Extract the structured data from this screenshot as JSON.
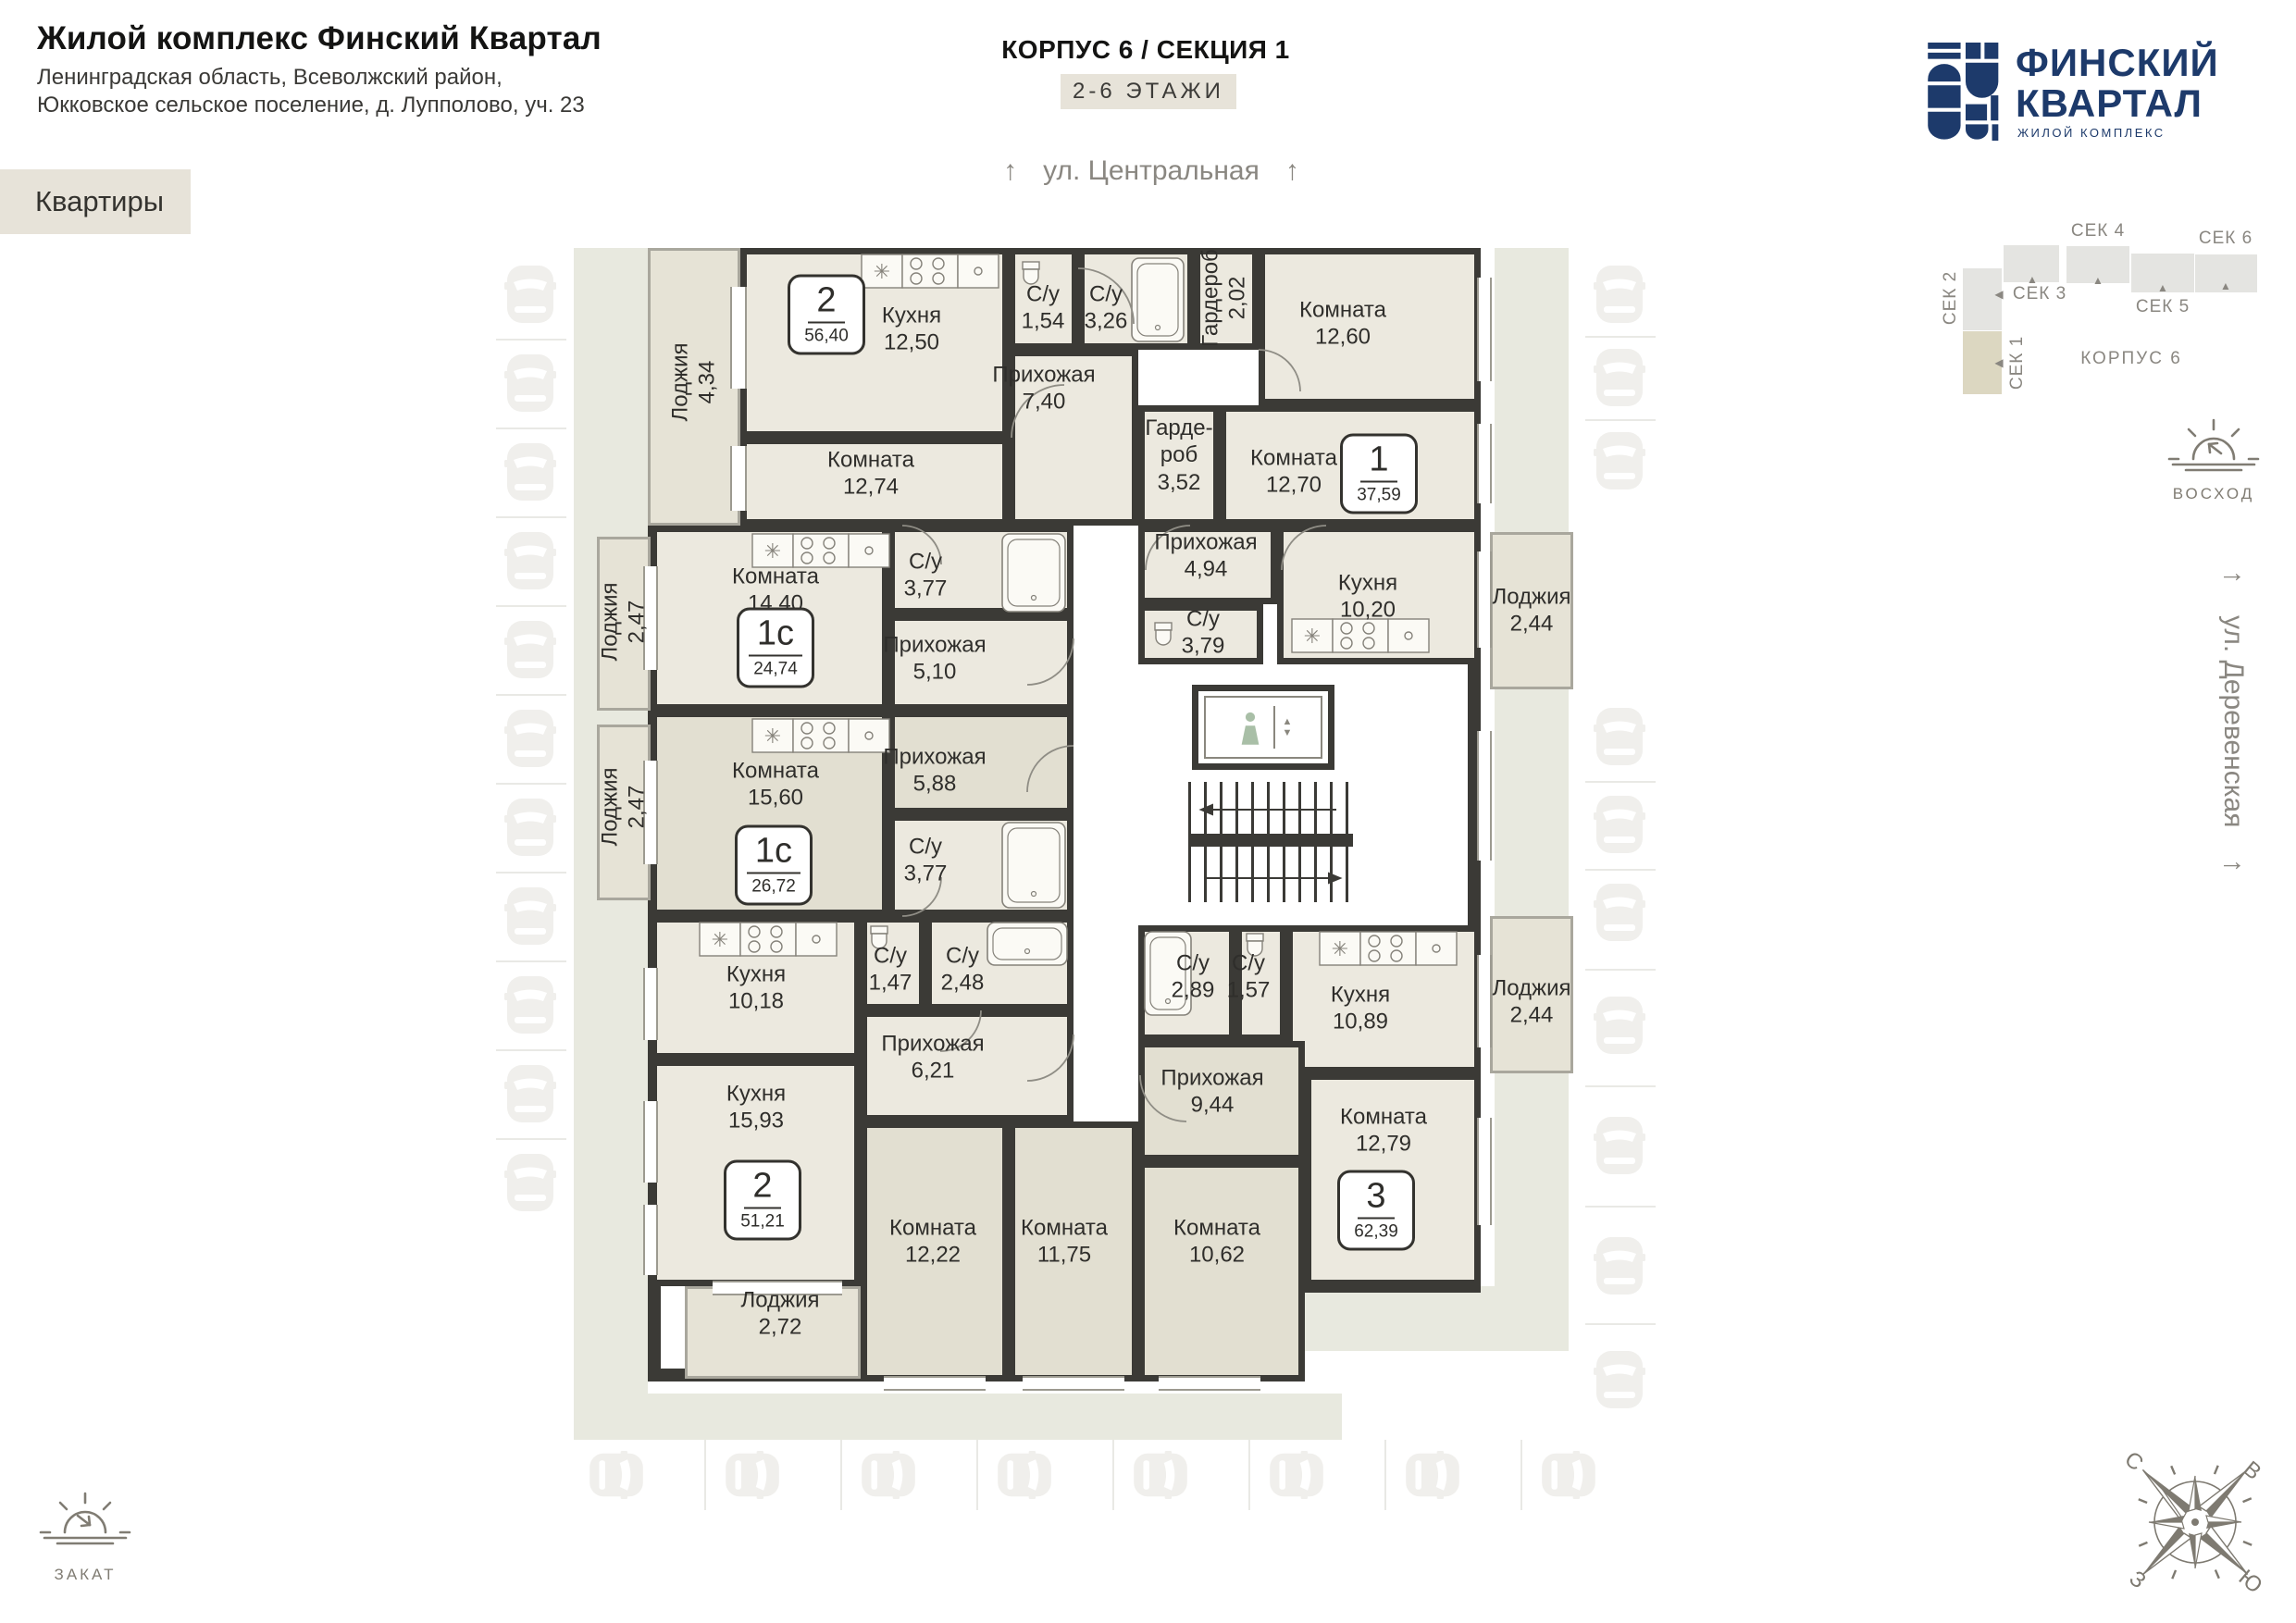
{
  "header": {
    "title": "Жилой комплекс Финский Квартал",
    "subtitle1": "Ленинградская область, Всеволжский район,",
    "subtitle2": "Юкковское сельское поселение, д. Лупполово, уч. 23",
    "tab_label": "Квартиры",
    "corpus_title": "КОРПУС 6 / СЕКЦИЯ 1",
    "floors_label": "2-6 ЭТАЖИ"
  },
  "streets": {
    "top": "ул. Центральная",
    "right": "ул. Деревенская",
    "arrow_up": "↑"
  },
  "logo": {
    "line1": "ФИНСКИЙ",
    "line2": "КВАРТАЛ",
    "subline": "ЖИЛОЙ КОМПЛЕКС"
  },
  "section_map": {
    "corpus_label": "КОРПУС 6",
    "sections": [
      {
        "id": "sek1",
        "label": "СЕК 1",
        "active": true
      },
      {
        "id": "sek2",
        "label": "СЕК 2",
        "active": false
      },
      {
        "id": "sek3",
        "label": "СЕК 3",
        "active": false
      },
      {
        "id": "sek4",
        "label": "СЕК 4",
        "active": false
      },
      {
        "id": "sek5",
        "label": "СЕК 5",
        "active": false
      },
      {
        "id": "sek6",
        "label": "СЕК 6",
        "active": false
      }
    ]
  },
  "sun": {
    "rise": "ВОСХОД",
    "set": "ЗАКАТ"
  },
  "compass": {
    "n": "С",
    "e": "В",
    "s": "Ю",
    "w": "З"
  },
  "plan": {
    "apartments": [
      {
        "id": "a1",
        "num": "2",
        "area": "56,40"
      },
      {
        "id": "a2",
        "num": "1",
        "area": "37,59"
      },
      {
        "id": "a3",
        "num": "1с",
        "area": "24,74"
      },
      {
        "id": "a4",
        "num": "1с",
        "area": "26,72"
      },
      {
        "id": "a5",
        "num": "2",
        "area": "51,21"
      },
      {
        "id": "a6",
        "num": "3",
        "area": "62,39"
      }
    ],
    "rooms": [
      {
        "id": "loggia434",
        "name": "Лоджия",
        "area": "4,34"
      },
      {
        "id": "kit1250",
        "name": "Кухня",
        "area": "12,50"
      },
      {
        "id": "su154",
        "name": "С/у",
        "area": "1,54"
      },
      {
        "id": "su326",
        "name": "С/у",
        "area": "3,26"
      },
      {
        "id": "ward202",
        "name": "Гардероб",
        "area": "2,02"
      },
      {
        "id": "hall740",
        "name": "Прихожая",
        "area": "7,40"
      },
      {
        "id": "room1274",
        "name": "Комната",
        "area": "12,74"
      },
      {
        "id": "room1260",
        "name": "Комната",
        "area": "12,60"
      },
      {
        "id": "ward352",
        "name": "Гарде-\nроб",
        "area": "3,52"
      },
      {
        "id": "room1270",
        "name": "Комната",
        "area": "12,70"
      },
      {
        "id": "hall494",
        "name": "Прихожая",
        "area": "4,94"
      },
      {
        "id": "su379",
        "name": "С/у",
        "area": "3,79"
      },
      {
        "id": "kit1020",
        "name": "Кухня",
        "area": "10,20"
      },
      {
        "id": "loggia244t",
        "name": "Лоджия",
        "area": "2,44"
      },
      {
        "id": "loggia247a",
        "name": "Лоджия",
        "area": "2,47"
      },
      {
        "id": "room1440",
        "name": "Комната",
        "area": "14,40"
      },
      {
        "id": "su377a",
        "name": "С/у",
        "area": "3,77"
      },
      {
        "id": "hall510",
        "name": "Прихожая",
        "area": "5,10"
      },
      {
        "id": "loggia247b",
        "name": "Лоджия",
        "area": "2,47"
      },
      {
        "id": "room1560",
        "name": "Комната",
        "area": "15,60"
      },
      {
        "id": "hall588",
        "name": "Прихожая",
        "area": "5,88"
      },
      {
        "id": "su377b",
        "name": "С/у",
        "area": "3,77"
      },
      {
        "id": "kit1018",
        "name": "Кухня",
        "area": "10,18"
      },
      {
        "id": "su147",
        "name": "С/у",
        "area": "1,47"
      },
      {
        "id": "su248",
        "name": "С/у",
        "area": "2,48"
      },
      {
        "id": "hall621",
        "name": "Прихожая",
        "area": "6,21"
      },
      {
        "id": "kit1593",
        "name": "Кухня",
        "area": "15,93"
      },
      {
        "id": "loggia272",
        "name": "Лоджия",
        "area": "2,72"
      },
      {
        "id": "room1222",
        "name": "Комната",
        "area": "12,22"
      },
      {
        "id": "su289",
        "name": "С/у",
        "area": "2,89"
      },
      {
        "id": "su157",
        "name": "С/у",
        "area": "1,57"
      },
      {
        "id": "kit1089",
        "name": "Кухня",
        "area": "10,89"
      },
      {
        "id": "loggia244b",
        "name": "Лоджия",
        "area": "2,44"
      },
      {
        "id": "hall944",
        "name": "Прихожая",
        "area": "9,44"
      },
      {
        "id": "room1279",
        "name": "Комната",
        "area": "12,79"
      },
      {
        "id": "room1175",
        "name": "Комната",
        "area": "11,75"
      },
      {
        "id": "room1062",
        "name": "Комната",
        "area": "10,62"
      }
    ],
    "parking": {
      "left_spots": 11,
      "right_spots": 10,
      "bottom_spots": 8
    }
  },
  "colors": {
    "wall": "#3b3a36",
    "room_light": "#ece9df",
    "room_dark": "#e2dfd1",
    "walkway": "#e8e9df",
    "navy": "#1d3a6b",
    "muted": "#8a8781",
    "chip": "#e7e3d9"
  }
}
